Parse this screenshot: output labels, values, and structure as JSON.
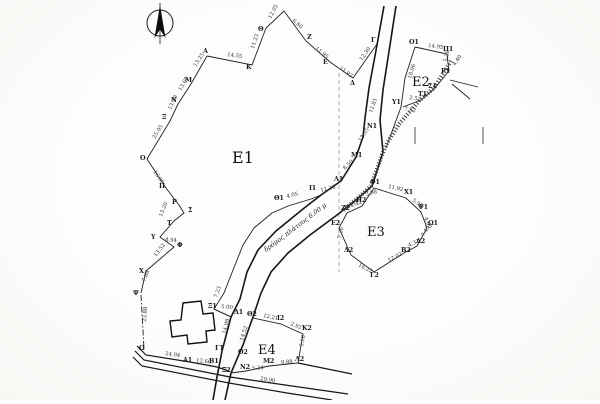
{
  "map": {
    "north_arrow": "north-arrow",
    "parcels": [
      {
        "id": "E1",
        "label": "Ε1"
      },
      {
        "id": "E2",
        "label": "Ε2"
      },
      {
        "id": "E3",
        "label": "Ε3"
      },
      {
        "id": "E4",
        "label": "Ε4"
      }
    ],
    "road_label": "δρόμος πλάτους 6.00 μ",
    "labels": [
      {
        "t": "Α",
        "x": 203,
        "y": 53,
        "r": 0,
        "c": "pt"
      },
      {
        "t": "Κ",
        "x": 246,
        "y": 69,
        "r": 0,
        "c": "pt"
      },
      {
        "t": "Θ",
        "x": 258,
        "y": 31,
        "r": 0,
        "c": "pt"
      },
      {
        "t": "Ζ",
        "x": 307,
        "y": 39,
        "r": 0,
        "c": "pt"
      },
      {
        "t": "Ε",
        "x": 323,
        "y": 64,
        "r": 0,
        "c": "pt"
      },
      {
        "t": "Δ",
        "x": 350,
        "y": 85,
        "r": 0,
        "c": "pt"
      },
      {
        "t": "Γ",
        "x": 371,
        "y": 42,
        "r": 0,
        "c": "pt"
      },
      {
        "t": "Μ",
        "x": 185,
        "y": 82,
        "r": 0,
        "c": "pt"
      },
      {
        "t": "Ν",
        "x": 171,
        "y": 102,
        "r": 0,
        "c": "pt"
      },
      {
        "t": "Ξ",
        "x": 162,
        "y": 119,
        "r": 0,
        "c": "pt"
      },
      {
        "t": "Ο",
        "x": 140,
        "y": 160,
        "r": 0,
        "c": "pt"
      },
      {
        "t": "Π",
        "x": 159,
        "y": 188,
        "r": 0,
        "c": "pt"
      },
      {
        "t": "Ρ",
        "x": 172,
        "y": 204,
        "r": 0,
        "c": "pt"
      },
      {
        "t": "Σ",
        "x": 188,
        "y": 212,
        "r": 0,
        "c": "pt"
      },
      {
        "t": "Τ",
        "x": 167,
        "y": 225,
        "r": 0,
        "c": "pt"
      },
      {
        "t": "Υ",
        "x": 151,
        "y": 239,
        "r": 0,
        "c": "pt"
      },
      {
        "t": "Φ",
        "x": 177,
        "y": 247,
        "r": 0,
        "c": "pt"
      },
      {
        "t": "Χ",
        "x": 139,
        "y": 273,
        "r": 0,
        "c": "pt"
      },
      {
        "t": "Ψ",
        "x": 133,
        "y": 295,
        "r": 0,
        "c": "pt"
      },
      {
        "t": "Ω",
        "x": 139,
        "y": 350,
        "r": 0,
        "c": "pt"
      },
      {
        "t": "Ν1",
        "x": 367,
        "y": 128,
        "r": 0,
        "c": "pt"
      },
      {
        "t": "Μ1",
        "x": 351,
        "y": 157,
        "r": 0,
        "c": "pt"
      },
      {
        "t": "Λ1",
        "x": 334,
        "y": 181,
        "r": 0,
        "c": "pt"
      },
      {
        "t": "Ι1",
        "x": 309,
        "y": 190,
        "r": 0,
        "c": "pt"
      },
      {
        "t": "Θ1",
        "x": 274,
        "y": 200,
        "r": 0,
        "c": "pt"
      },
      {
        "t": "Ξ1",
        "x": 208,
        "y": 308,
        "r": 0,
        "c": "pt"
      },
      {
        "t": "Δ1",
        "x": 234,
        "y": 314,
        "r": 0,
        "c": "pt"
      },
      {
        "t": "Γ1",
        "x": 215,
        "y": 350,
        "r": 0,
        "c": "pt"
      },
      {
        "t": "Ο1",
        "x": 409,
        "y": 44,
        "r": 0,
        "c": "pt"
      },
      {
        "t": "Π1",
        "x": 443,
        "y": 51,
        "r": 0,
        "c": "pt"
      },
      {
        "t": "Ρ1",
        "x": 441,
        "y": 73,
        "r": 0,
        "c": "pt"
      },
      {
        "t": "Σ1",
        "x": 428,
        "y": 88,
        "r": 0,
        "c": "pt"
      },
      {
        "t": "Τ1",
        "x": 418,
        "y": 96,
        "r": 0,
        "c": "pt"
      },
      {
        "t": "Υ1",
        "x": 392,
        "y": 104,
        "r": 0,
        "c": "pt"
      },
      {
        "t": "Φ1",
        "x": 370,
        "y": 184,
        "r": 0,
        "c": "pt"
      },
      {
        "t": "Χ1",
        "x": 404,
        "y": 194,
        "r": 0,
        "c": "pt"
      },
      {
        "t": "Ψ1",
        "x": 418,
        "y": 209,
        "r": 0,
        "c": "pt"
      },
      {
        "t": "Ω1",
        "x": 428,
        "y": 225,
        "r": 0,
        "c": "pt"
      },
      {
        "t": "Α2",
        "x": 416,
        "y": 243,
        "r": 0,
        "c": "pt"
      },
      {
        "t": "Β2",
        "x": 401,
        "y": 252,
        "r": 0,
        "c": "pt"
      },
      {
        "t": "Γ2",
        "x": 370,
        "y": 277,
        "r": 0,
        "c": "pt"
      },
      {
        "t": "Δ2",
        "x": 344,
        "y": 252,
        "r": 0,
        "c": "pt"
      },
      {
        "t": "Ε2",
        "x": 331,
        "y": 225,
        "r": 0,
        "c": "pt"
      },
      {
        "t": "Ζ2",
        "x": 341,
        "y": 210,
        "r": 0,
        "c": "pt"
      },
      {
        "t": "Η2",
        "x": 356,
        "y": 202,
        "r": 0,
        "c": "pt"
      },
      {
        "t": "Θ2",
        "x": 247,
        "y": 316,
        "r": 0,
        "c": "pt"
      },
      {
        "t": "Ι2",
        "x": 277,
        "y": 320,
        "r": 0,
        "c": "pt"
      },
      {
        "t": "Κ2",
        "x": 302,
        "y": 330,
        "r": 0,
        "c": "pt"
      },
      {
        "t": "Λ2",
        "x": 295,
        "y": 361,
        "r": 0,
        "c": "pt"
      },
      {
        "t": "Μ2",
        "x": 263,
        "y": 363,
        "r": 0,
        "c": "pt"
      },
      {
        "t": "Ν2",
        "x": 240,
        "y": 369,
        "r": 0,
        "c": "pt"
      },
      {
        "t": "Ξ2",
        "x": 222,
        "y": 372,
        "r": 0,
        "c": "pt"
      },
      {
        "t": "Ο2",
        "x": 238,
        "y": 354,
        "r": 0,
        "c": "pt"
      },
      {
        "t": "Α1",
        "x": 183,
        "y": 362,
        "r": 0,
        "c": "pt"
      },
      {
        "t": "Β1",
        "x": 209,
        "y": 363,
        "r": 0,
        "c": "pt"
      },
      {
        "t": "14.55",
        "x": 227,
        "y": 56,
        "r": 8,
        "c": "ms"
      },
      {
        "t": "11.23",
        "x": 254,
        "y": 49,
        "r": -72,
        "c": "ms"
      },
      {
        "t": "12.05",
        "x": 271,
        "y": 19,
        "r": -62,
        "c": "ms"
      },
      {
        "t": "6.80",
        "x": 292,
        "y": 21,
        "r": 42,
        "c": "ms"
      },
      {
        "t": "11.95",
        "x": 315,
        "y": 49,
        "r": 40,
        "c": "ms"
      },
      {
        "t": "11.92",
        "x": 339,
        "y": 69,
        "r": 35,
        "c": "ms"
      },
      {
        "t": "12.30",
        "x": 362,
        "y": 61,
        "r": -55,
        "c": "ms"
      },
      {
        "t": "13.25",
        "x": 196,
        "y": 67,
        "r": -57,
        "c": "ms"
      },
      {
        "t": "13.60",
        "x": 181,
        "y": 91,
        "r": -60,
        "c": "ms"
      },
      {
        "t": "13.10",
        "x": 171,
        "y": 110,
        "r": -65,
        "c": "ms"
      },
      {
        "t": "25.05",
        "x": 155,
        "y": 139,
        "r": -58,
        "c": "ms"
      },
      {
        "t": "16.00",
        "x": 153,
        "y": 172,
        "r": 55,
        "c": "ms"
      },
      {
        "t": "13.20",
        "x": 162,
        "y": 217,
        "r": -68,
        "c": "ms"
      },
      {
        "t": "4.94",
        "x": 165,
        "y": 241,
        "r": 5,
        "c": "ms"
      },
      {
        "t": "13.52",
        "x": 156,
        "y": 257,
        "r": -52,
        "c": "ms"
      },
      {
        "t": "7.68",
        "x": 145,
        "y": 282,
        "r": -68,
        "c": "ms"
      },
      {
        "t": "23.88",
        "x": 146,
        "y": 322,
        "r": -86,
        "c": "ms"
      },
      {
        "t": "24.94",
        "x": 165,
        "y": 355,
        "r": 8,
        "c": "ms"
      },
      {
        "t": "12.66",
        "x": 196,
        "y": 362,
        "r": 6,
        "c": "ms"
      },
      {
        "t": "29.90",
        "x": 260,
        "y": 380,
        "r": 9,
        "c": "ms"
      },
      {
        "t": "7.23",
        "x": 217,
        "y": 298,
        "r": -70,
        "c": "ms"
      },
      {
        "t": "5.00",
        "x": 221,
        "y": 308,
        "r": 5,
        "c": "ms"
      },
      {
        "t": "14.98",
        "x": 226,
        "y": 334,
        "r": -78,
        "c": "ms"
      },
      {
        "t": "14.52",
        "x": 243,
        "y": 341,
        "r": -72,
        "c": "ms"
      },
      {
        "t": "12.21",
        "x": 263,
        "y": 317,
        "r": 12,
        "c": "ms"
      },
      {
        "t": "2.92",
        "x": 290,
        "y": 325,
        "r": 22,
        "c": "ms"
      },
      {
        "t": "5.18",
        "x": 303,
        "y": 347,
        "r": -80,
        "c": "ms"
      },
      {
        "t": "9.88",
        "x": 281,
        "y": 364,
        "r": -4,
        "c": "ms"
      },
      {
        "t": "5.34",
        "x": 252,
        "y": 370,
        "r": -4,
        "c": "ms"
      },
      {
        "t": "12.81",
        "x": 372,
        "y": 113,
        "r": -70,
        "c": "ms"
      },
      {
        "t": "13.55",
        "x": 361,
        "y": 142,
        "r": -58,
        "c": "ms"
      },
      {
        "t": "8.50",
        "x": 345,
        "y": 170,
        "r": -45,
        "c": "ms"
      },
      {
        "t": "11.26",
        "x": 321,
        "y": 192,
        "r": -14,
        "c": "ms"
      },
      {
        "t": "4.05",
        "x": 287,
        "y": 198,
        "r": -14,
        "c": "ms"
      },
      {
        "t": "18.06",
        "x": 411,
        "y": 79,
        "r": -73,
        "c": "ms"
      },
      {
        "t": "14.95",
        "x": 428,
        "y": 47,
        "r": 8,
        "c": "ms"
      },
      {
        "t": "5.28",
        "x": 447,
        "y": 62,
        "r": -78,
        "c": "ms"
      },
      {
        "t": "4.40",
        "x": 455,
        "y": 66,
        "r": -55,
        "c": "ms"
      },
      {
        "t": "2.52",
        "x": 409,
        "y": 99,
        "r": 10,
        "c": "ms"
      },
      {
        "t": "7.52",
        "x": 404,
        "y": 110,
        "r": 12,
        "c": "ms"
      },
      {
        "t": "11.92",
        "x": 388,
        "y": 188,
        "r": 12,
        "c": "ms"
      },
      {
        "t": "5.90",
        "x": 412,
        "y": 201,
        "r": 35,
        "c": "ms"
      },
      {
        "t": "4.60",
        "x": 424,
        "y": 218,
        "r": 65,
        "c": "ms"
      },
      {
        "t": "7.45",
        "x": 424,
        "y": 237,
        "r": -60,
        "c": "ms"
      },
      {
        "t": "4.32",
        "x": 409,
        "y": 247,
        "r": -25,
        "c": "ms"
      },
      {
        "t": "12.02",
        "x": 389,
        "y": 262,
        "r": -28,
        "c": "ms"
      },
      {
        "t": "16.22",
        "x": 358,
        "y": 266,
        "r": 28,
        "c": "ms"
      },
      {
        "t": "7.26",
        "x": 341,
        "y": 239,
        "r": -78,
        "c": "ms"
      },
      {
        "t": "2.42",
        "x": 351,
        "y": 207,
        "r": -18,
        "c": "ms"
      },
      {
        "t": "3.98",
        "x": 366,
        "y": 196,
        "r": -15,
        "c": "ms"
      }
    ]
  }
}
